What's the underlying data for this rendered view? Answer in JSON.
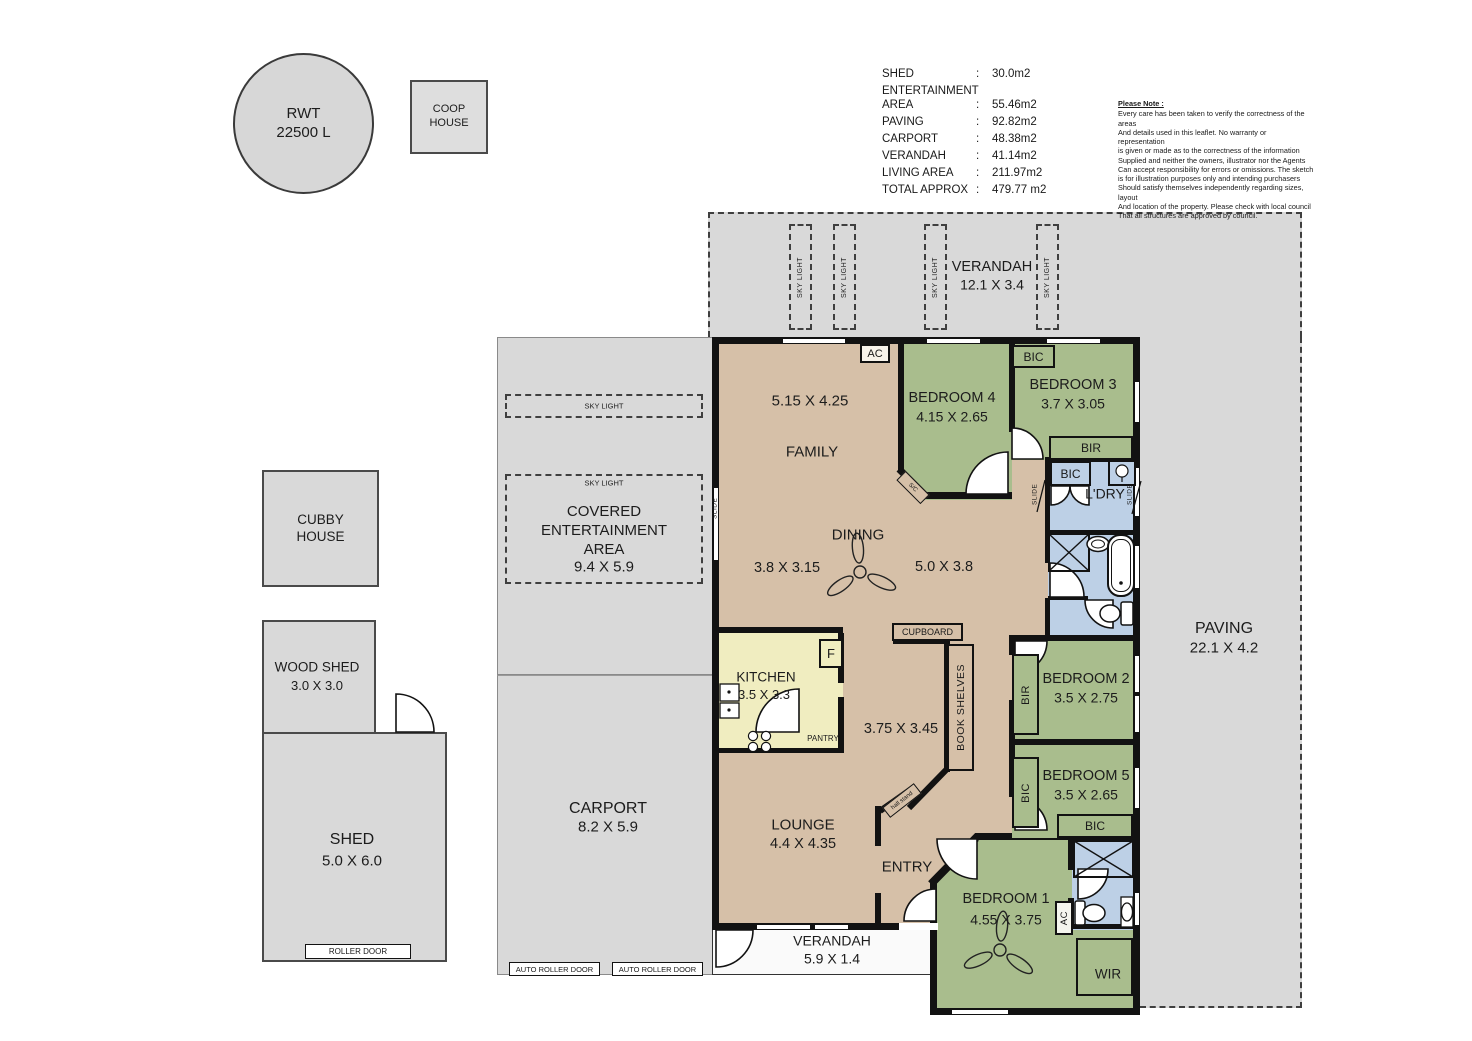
{
  "site": {
    "rwt": "RWT\n22500 L",
    "coop": "COOP\nHOUSE",
    "cubby": "CUBBY\nHOUSE",
    "woodshed_name": "WOOD SHED",
    "woodshed_dim": "3.0 X 3.0",
    "shed_name": "SHED",
    "shed_dim": "5.0 X 6.0",
    "roller_door": "ROLLER DOOR",
    "auto_roller_door": "AUTO ROLLER DOOR"
  },
  "summary": {
    "colon": ":",
    "rows": [
      {
        "label": "SHED",
        "value": "30.0m2"
      },
      {
        "label": "ENTERTAINMENT\nAREA",
        "value": "55.46m2"
      },
      {
        "label": "PAVING",
        "value": "92.82m2"
      },
      {
        "label": "CARPORT",
        "value": "48.38m2"
      },
      {
        "label": "VERANDAH",
        "value": "41.14m2"
      },
      {
        "label": "LIVING AREA",
        "value": "211.97m2"
      },
      {
        "label": "TOTAL APPROX",
        "value": "479.77 m2"
      }
    ]
  },
  "note": {
    "title": "Please Note :",
    "body": "Every care has been taken to verify the correctness of the areas\nAnd details used in this leaflet. No warranty or representation\nis given or made as to the correctness of the information\nSupplied and neither the owners, illustrator nor the Agents\nCan accept responsibility for errors or omissions. The sketch\nis for illustration purposes only and intending purchasers\nShould satisfy themselves independently regarding sizes, layout\nAnd location of the property. Please check with local council\nThat all structures are approved by council."
  },
  "rooms": {
    "verandah_top": {
      "name": "VERANDAH",
      "dim": "12.1 X 3.4"
    },
    "paving": {
      "name": "PAVING",
      "dim": "22.1 X 4.2"
    },
    "covered": {
      "name": "COVERED\nENTERTAINMENT\nAREA",
      "dim": "9.4 X 5.9"
    },
    "carport": {
      "name": "CARPORT",
      "dim": "8.2 X 5.9"
    },
    "verandah_bottom": {
      "name": "VERANDAH",
      "dim": "5.9 X 1.4"
    },
    "family": {
      "name": "FAMILY",
      "dim": "5.15 X 4.25"
    },
    "dining": {
      "name": "DINING",
      "dim_left": "3.8 X 3.15",
      "dim_right": "5.0 X 3.8"
    },
    "kitchen": {
      "name": "KITCHEN",
      "dim": "3.5 X 3.3"
    },
    "hall": {
      "dim": "3.75 X 3.45"
    },
    "lounge": {
      "name": "LOUNGE",
      "dim": "4.4 X 4.35"
    },
    "entry": {
      "name": "ENTRY"
    },
    "ldry": {
      "name": "L'DRY"
    },
    "wir": {
      "name": "WIR"
    },
    "bed1": {
      "name": "BEDROOM 1",
      "dim": "4.55 X 3.75"
    },
    "bed2": {
      "name": "BEDROOM 2",
      "dim": "3.5 X 2.75"
    },
    "bed3": {
      "name": "BEDROOM 3",
      "dim": "3.7 X 3.05"
    },
    "bed4": {
      "name": "BEDROOM 4",
      "dim": "4.15 X 2.65"
    },
    "bed5": {
      "name": "BEDROOM 5",
      "dim": "3.5 X 2.65"
    }
  },
  "labels": {
    "bic": "BIC",
    "bir": "BIR",
    "ac": "AC",
    "slide": "SLIDE",
    "sky_light": "SKY LIGHT",
    "cupboard": "CUPBOARD",
    "book_shelves": "BOOK SHELVES",
    "pantry": "PANTRY",
    "fridge": "F",
    "hall_stand": "hall stand",
    "sc": "S/C"
  },
  "colors": {
    "living": "#d6c0a8",
    "bedroom": "#a9bd8d",
    "wet": "#bdd0e6",
    "kitchen": "#f0edc0",
    "outdoor": "#d9d9d9",
    "wall": "#121212"
  }
}
